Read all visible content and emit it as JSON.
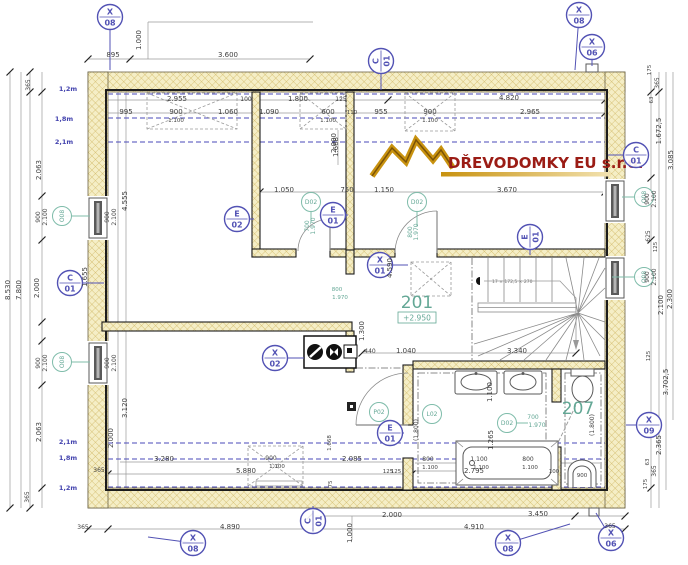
{
  "logo": {
    "company": "DŘEVODOMKY EU s.r.o."
  },
  "rooms": [
    {
      "number": "201",
      "level": "+2.950"
    },
    {
      "number": "207"
    }
  ],
  "stairs": {
    "note": "17 × 172,5 × 270"
  },
  "colors": {
    "wall_fill": "#f5eec6",
    "wall_hatch": "#cdb45e",
    "marker_blue": "#5252b4",
    "marker_green": "#7fbcaa",
    "logo_red": "#9b1c15",
    "logo_gold": "#c8920f",
    "height_line_blue": "#4a4ab8"
  },
  "dim_texts": [
    {
      "t": "895",
      "x": 113,
      "y": 57
    },
    {
      "t": "1.000",
      "x": 141,
      "y": 40,
      "r": 90
    },
    {
      "t": "3.600",
      "x": 228,
      "y": 57
    },
    {
      "t": "2.955",
      "x": 177,
      "y": 101
    },
    {
      "t": "100",
      "x": 246,
      "y": 101,
      "s": 6
    },
    {
      "t": "1.800",
      "x": 298,
      "y": 101
    },
    {
      "t": "125",
      "x": 341,
      "y": 101,
      "s": 6
    },
    {
      "t": "4.820",
      "x": 509,
      "y": 100
    },
    {
      "t": "995",
      "x": 126,
      "y": 114
    },
    {
      "t": "900",
      "x": 176,
      "y": 114
    },
    {
      "t": "1.100",
      "x": 176,
      "y": 122,
      "s": 5.5
    },
    {
      "t": "1.060",
      "x": 228,
      "y": 114
    },
    {
      "t": "1.090",
      "x": 269,
      "y": 114
    },
    {
      "t": "600",
      "x": 328,
      "y": 114
    },
    {
      "t": "1.100",
      "x": 328,
      "y": 122,
      "s": 5.5
    },
    {
      "t": "110",
      "x": 352,
      "y": 114,
      "s": 5.5
    },
    {
      "t": "955",
      "x": 381,
      "y": 114
    },
    {
      "t": "900",
      "x": 430,
      "y": 114
    },
    {
      "t": "1.100",
      "x": 430,
      "y": 122,
      "s": 5.5
    },
    {
      "t": "2.965",
      "x": 530,
      "y": 114
    },
    {
      "t": "1.668",
      "x": 338,
      "y": 147,
      "r": 90
    },
    {
      "t": "175",
      "x": 651,
      "y": 70,
      "r": 90,
      "s": 5.5
    },
    {
      "t": "365",
      "x": 659,
      "y": 83,
      "r": 90,
      "s": 6
    },
    {
      "t": "63",
      "x": 653,
      "y": 100,
      "r": 90,
      "s": 5.5
    },
    {
      "t": "1.672,5",
      "x": 661,
      "y": 131,
      "r": 90
    },
    {
      "t": "3.085",
      "x": 673,
      "y": 160,
      "r": 90
    },
    {
      "t": "365",
      "x": 30,
      "y": 85,
      "r": 90,
      "s": 6
    },
    {
      "t": "2.063",
      "x": 41,
      "y": 170,
      "r": 90
    },
    {
      "t": "900",
      "x": 40,
      "y": 217,
      "r": 90,
      "s": 6
    },
    {
      "t": "2.100",
      "x": 47,
      "y": 217,
      "r": 90,
      "s": 6
    },
    {
      "t": "900",
      "x": 109,
      "y": 217,
      "r": 90,
      "s": 6
    },
    {
      "t": "2.100",
      "x": 116,
      "y": 217,
      "r": 90,
      "s": 6
    },
    {
      "t": "2.000",
      "x": 39,
      "y": 288,
      "r": 90
    },
    {
      "t": "1.655",
      "x": 87,
      "y": 277,
      "r": 90
    },
    {
      "t": "4.555",
      "x": 127,
      "y": 201,
      "r": 90
    },
    {
      "t": "2.000",
      "x": 336,
      "y": 143,
      "r": 90
    },
    {
      "t": "8.530",
      "x": 10,
      "y": 290,
      "r": 90
    },
    {
      "t": "7.800",
      "x": 21,
      "y": 290,
      "r": 90
    },
    {
      "t": "2.063",
      "x": 41,
      "y": 432,
      "r": 90
    },
    {
      "t": "900",
      "x": 40,
      "y": 363,
      "r": 90,
      "s": 6
    },
    {
      "t": "2.100",
      "x": 47,
      "y": 363,
      "r": 90,
      "s": 6
    },
    {
      "t": "900",
      "x": 109,
      "y": 363,
      "r": 90,
      "s": 6
    },
    {
      "t": "2.100",
      "x": 116,
      "y": 363,
      "r": 90,
      "s": 6
    },
    {
      "t": "365",
      "x": 29,
      "y": 497,
      "r": 90,
      "s": 6
    },
    {
      "t": "3.120",
      "x": 127,
      "y": 408,
      "r": 90
    },
    {
      "t": "2.000",
      "x": 113,
      "y": 438,
      "r": 90
    },
    {
      "t": "365",
      "x": 99,
      "y": 472,
      "s": 6
    },
    {
      "t": "1,2m",
      "x": 68,
      "y": 91,
      "c": "blue",
      "s": 6.5
    },
    {
      "t": "1,8m",
      "x": 64,
      "y": 121,
      "c": "blue",
      "s": 6.5
    },
    {
      "t": "2,1m",
      "x": 64,
      "y": 144,
      "c": "blue",
      "s": 6.5
    },
    {
      "t": "2,1m",
      "x": 68,
      "y": 444,
      "c": "blue",
      "s": 6.5
    },
    {
      "t": "1,8m",
      "x": 68,
      "y": 460,
      "c": "blue",
      "s": 6.5
    },
    {
      "t": "1,2m",
      "x": 68,
      "y": 490,
      "c": "blue",
      "s": 6.5
    },
    {
      "t": "1.050",
      "x": 284,
      "y": 192
    },
    {
      "t": "750",
      "x": 347,
      "y": 192
    },
    {
      "t": "1.150",
      "x": 384,
      "y": 192
    },
    {
      "t": "3.670",
      "x": 507,
      "y": 192
    },
    {
      "t": "700",
      "x": 309,
      "y": 226,
      "r": 90,
      "c": "green",
      "s": 6
    },
    {
      "t": "1.970",
      "x": 315,
      "y": 226,
      "r": 90,
      "c": "green",
      "s": 6
    },
    {
      "t": "800",
      "x": 412,
      "y": 232,
      "r": 90,
      "c": "green",
      "s": 6
    },
    {
      "t": "1.970",
      "x": 418,
      "y": 232,
      "r": 90,
      "c": "green",
      "s": 6
    },
    {
      "t": "4.590",
      "x": 392,
      "y": 268,
      "r": 90
    },
    {
      "t": "1.300",
      "x": 364,
      "y": 331,
      "r": 90
    },
    {
      "t": "800",
      "x": 337,
      "y": 291,
      "c": "green",
      "s": 5.5
    },
    {
      "t": "1.970",
      "x": 340,
      "y": 299,
      "c": "green",
      "s": 5.5
    },
    {
      "t": "440",
      "x": 370,
      "y": 353,
      "s": 6
    },
    {
      "t": "1.040",
      "x": 406,
      "y": 353
    },
    {
      "t": "3.340",
      "x": 517,
      "y": 353
    },
    {
      "t": "3.280",
      "x": 164,
      "y": 461
    },
    {
      "t": "5.880",
      "x": 246,
      "y": 473
    },
    {
      "t": "900",
      "x": 271,
      "y": 460,
      "s": 6
    },
    {
      "t": "1.100",
      "x": 277,
      "y": 468,
      "s": 5.5
    },
    {
      "t": "2.085",
      "x": 352,
      "y": 461
    },
    {
      "t": "125",
      "x": 396,
      "y": 473,
      "s": 5.5
    },
    {
      "t": "75",
      "x": 332,
      "y": 484,
      "r": 90,
      "s": 5.5
    },
    {
      "t": "1.668",
      "x": 331,
      "y": 443,
      "r": 90,
      "s": 5.5
    },
    {
      "t": "1.100",
      "x": 492,
      "y": 392,
      "r": 90
    },
    {
      "t": "1.265",
      "x": 493,
      "y": 440,
      "r": 90
    },
    {
      "t": "700",
      "x": 533,
      "y": 419,
      "c": "green",
      "s": 6
    },
    {
      "t": "1.970",
      "x": 537,
      "y": 427,
      "c": "green",
      "s": 6
    },
    {
      "t": "(1.800)",
      "x": 418,
      "y": 430,
      "r": 90,
      "s": 6
    },
    {
      "t": "(1.800)",
      "x": 594,
      "y": 425,
      "r": 90,
      "s": 6
    },
    {
      "t": "800",
      "x": 428,
      "y": 461,
      "s": 6
    },
    {
      "t": "1.100",
      "x": 430,
      "y": 469,
      "s": 5.5
    },
    {
      "t": "1.100",
      "x": 479,
      "y": 461,
      "s": 6
    },
    {
      "t": "1.100",
      "x": 481,
      "y": 469,
      "s": 5.5
    },
    {
      "t": "800",
      "x": 528,
      "y": 461,
      "s": 6
    },
    {
      "t": "1.100",
      "x": 530,
      "y": 469,
      "s": 5.5
    },
    {
      "t": "100",
      "x": 554,
      "y": 473,
      "s": 5.5
    },
    {
      "t": "900",
      "x": 582,
      "y": 477,
      "s": 5.5
    },
    {
      "t": "2.795",
      "x": 474,
      "y": 473
    },
    {
      "t": "125",
      "x": 388,
      "y": 473,
      "s": 5.5
    },
    {
      "t": "900",
      "x": 649,
      "y": 199,
      "r": 90,
      "s": 6
    },
    {
      "t": "2.100",
      "x": 656,
      "y": 199,
      "r": 90,
      "s": 6
    },
    {
      "t": "625",
      "x": 650,
      "y": 236,
      "r": 90,
      "s": 6
    },
    {
      "t": "125",
      "x": 657,
      "y": 247,
      "r": 90,
      "s": 5.5
    },
    {
      "t": "900",
      "x": 649,
      "y": 277,
      "r": 90,
      "s": 6
    },
    {
      "t": "2.100",
      "x": 656,
      "y": 277,
      "r": 90,
      "s": 6
    },
    {
      "t": "2.100",
      "x": 663,
      "y": 305,
      "r": 90
    },
    {
      "t": "2.300",
      "x": 672,
      "y": 299,
      "r": 90
    },
    {
      "t": "125",
      "x": 650,
      "y": 356,
      "r": 90,
      "s": 5.5
    },
    {
      "t": "3.702,5",
      "x": 668,
      "y": 382,
      "r": 90
    },
    {
      "t": "2.365",
      "x": 661,
      "y": 445,
      "r": 90
    },
    {
      "t": "63",
      "x": 649,
      "y": 462,
      "r": 90,
      "s": 5.5
    },
    {
      "t": "365",
      "x": 656,
      "y": 471,
      "r": 90,
      "s": 6
    },
    {
      "t": "175",
      "x": 647,
      "y": 484,
      "r": 90,
      "s": 5.5
    },
    {
      "t": "365",
      "x": 610,
      "y": 528,
      "s": 6
    },
    {
      "t": "2.000",
      "x": 392,
      "y": 517
    },
    {
      "t": "3.450",
      "x": 538,
      "y": 516
    },
    {
      "t": "4.890",
      "x": 230,
      "y": 529
    },
    {
      "t": "4.910",
      "x": 474,
      "y": 529
    },
    {
      "t": "365",
      "x": 83,
      "y": 529,
      "s": 6
    },
    {
      "t": "1.000",
      "x": 352,
      "y": 533,
      "r": 90
    }
  ],
  "markers": [
    {
      "l1": "X",
      "l2": "08",
      "x": 110,
      "y": 17,
      "leader": [
        110,
        70
      ]
    },
    {
      "l1": "X",
      "l2": "08",
      "x": 579,
      "y": 15,
      "leader": [
        575,
        70
      ]
    },
    {
      "l1": "X",
      "l2": "06",
      "x": 592,
      "y": 47,
      "leader": [
        592,
        66
      ]
    },
    {
      "l1": "C",
      "l2": "01",
      "x": 381,
      "y": 61,
      "rot": -90,
      "leader": [
        381,
        90
      ]
    },
    {
      "l1": "C",
      "l2": "01",
      "x": 636,
      "y": 155,
      "leader": [
        608,
        155
      ]
    },
    {
      "l1": "C",
      "l2": "01",
      "x": 70,
      "y": 283,
      "leader": [
        104,
        283
      ]
    },
    {
      "l1": "C",
      "l2": "01",
      "x": 313,
      "y": 521,
      "rot": -90,
      "leader": [
        313,
        506
      ]
    },
    {
      "l1": "E",
      "l2": "02",
      "x": 237,
      "y": 219,
      "leader": [
        254,
        219
      ]
    },
    {
      "l1": "E",
      "l2": "01",
      "x": 333,
      "y": 215,
      "leader": [
        348,
        215
      ]
    },
    {
      "l1": "E",
      "l2": "01",
      "x": 530,
      "y": 237,
      "rot": -90,
      "leader": [
        530,
        255
      ]
    },
    {
      "l1": "E",
      "l2": "01",
      "x": 390,
      "y": 433,
      "leader": [
        404,
        433
      ]
    },
    {
      "l1": "X",
      "l2": "01",
      "x": 380,
      "y": 265,
      "leader": [
        408,
        265
      ]
    },
    {
      "l1": "X",
      "l2": "02",
      "x": 275,
      "y": 358,
      "leader": [
        304,
        358
      ]
    },
    {
      "l1": "X",
      "l2": "09",
      "x": 649,
      "y": 425,
      "leader": [
        626,
        425
      ]
    },
    {
      "l1": "X",
      "l2": "08",
      "x": 193,
      "y": 543,
      "leader": [
        148,
        537
      ]
    },
    {
      "l1": "X",
      "l2": "08",
      "x": 508,
      "y": 543,
      "leader": [
        570,
        524
      ]
    },
    {
      "l1": "X",
      "l2": "06",
      "x": 611,
      "y": 538,
      "leader": [
        596,
        513
      ]
    },
    {
      "g": 1,
      "l1": "O08",
      "x": 62,
      "y": 216,
      "rot": -90,
      "leader": [
        90,
        216
      ]
    },
    {
      "g": 1,
      "l1": "O08",
      "x": 62,
      "y": 362,
      "rot": -90,
      "leader": [
        90,
        362
      ]
    },
    {
      "g": 1,
      "l1": "O08",
      "x": 644,
      "y": 197,
      "rot": -90,
      "leader": [
        622,
        197
      ]
    },
    {
      "g": 1,
      "l1": "O08",
      "x": 644,
      "y": 277,
      "rot": -90,
      "leader": [
        612,
        277
      ]
    },
    {
      "g": 1,
      "l1": "D02",
      "x": 311,
      "y": 202,
      "leader": [
        311,
        222
      ]
    },
    {
      "g": 1,
      "l1": "D02",
      "x": 417,
      "y": 202,
      "leader": [
        417,
        226
      ]
    },
    {
      "g": 1,
      "l1": "P02",
      "x": 379,
      "y": 412
    },
    {
      "g": 1,
      "l1": "L02",
      "x": 432,
      "y": 414
    },
    {
      "g": 1,
      "l1": "D02",
      "x": 507,
      "y": 423,
      "leader": [
        528,
        423
      ]
    }
  ]
}
